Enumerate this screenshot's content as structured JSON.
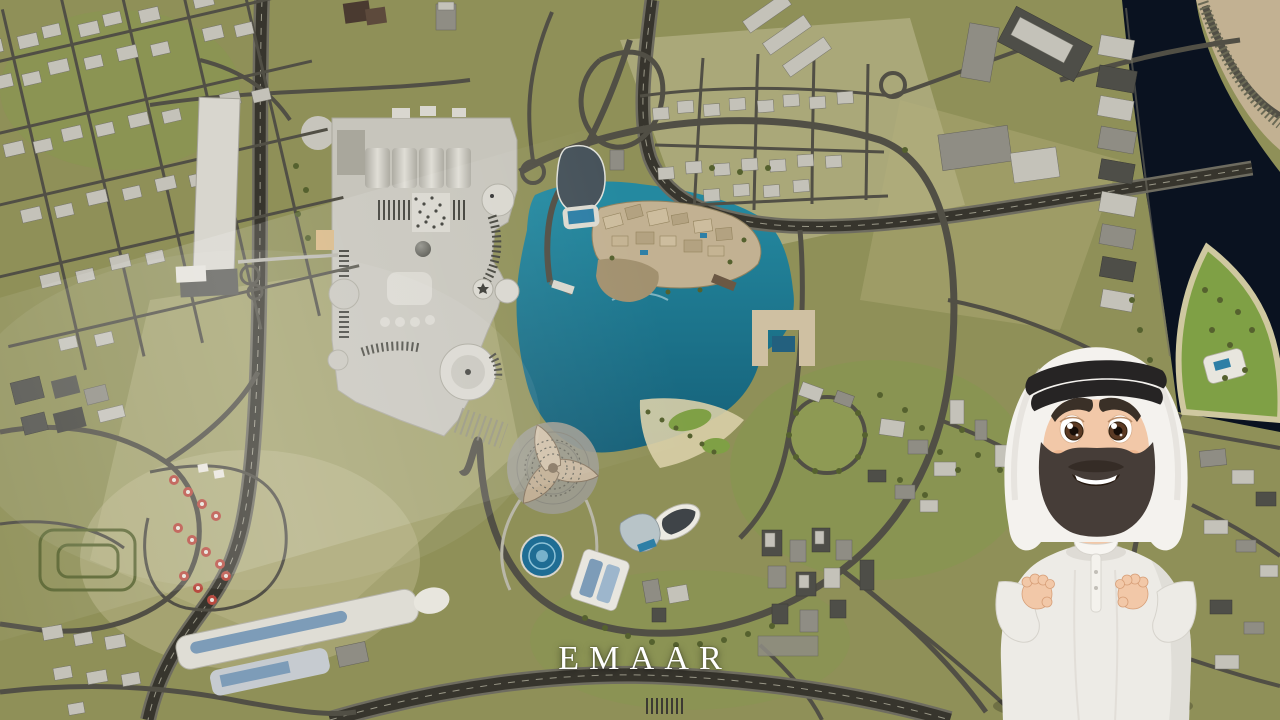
{
  "scene": {
    "watermark": "EMAAR",
    "view": "aerial-3d-map-downtown-dubai",
    "character": "cartoon-emirati-guide"
  },
  "colors": {
    "terrain": "#8f9058",
    "terrain-light": "#b3ae7e",
    "terrain-pale": "#c6c099",
    "lawn": "#7fa045",
    "road": "#514f45",
    "road-dark": "#37352d",
    "road-light": "#6e6c60",
    "lane": "#9a9888",
    "canal": "#0a1220",
    "lake-n": "#2489a0",
    "lake-s": "#0d4a63",
    "pool": "#2e7fa6",
    "beach": "#d9cfa8",
    "mall": "#c7c5bc",
    "mall-light": "#d9d7cf",
    "mall-dark": "#a9a79c",
    "bldg-light": "#c4c2b9",
    "bldg-mid": "#8f8d84",
    "bldg-dark": "#4e4e48",
    "tan": "#c2b192",
    "tan-dark": "#a2916f",
    "tree": "#55612e",
    "umbrella": "#b84b40",
    "skin": "#f2c8a8",
    "beard": "#463d38",
    "agal": "#262424",
    "ghutra": "#f4f2ee",
    "ghutra-shade": "#d9d6d0",
    "kandura": "#edebe6",
    "kandura-shade": "#d6d3cc",
    "text": "#ffffff"
  }
}
